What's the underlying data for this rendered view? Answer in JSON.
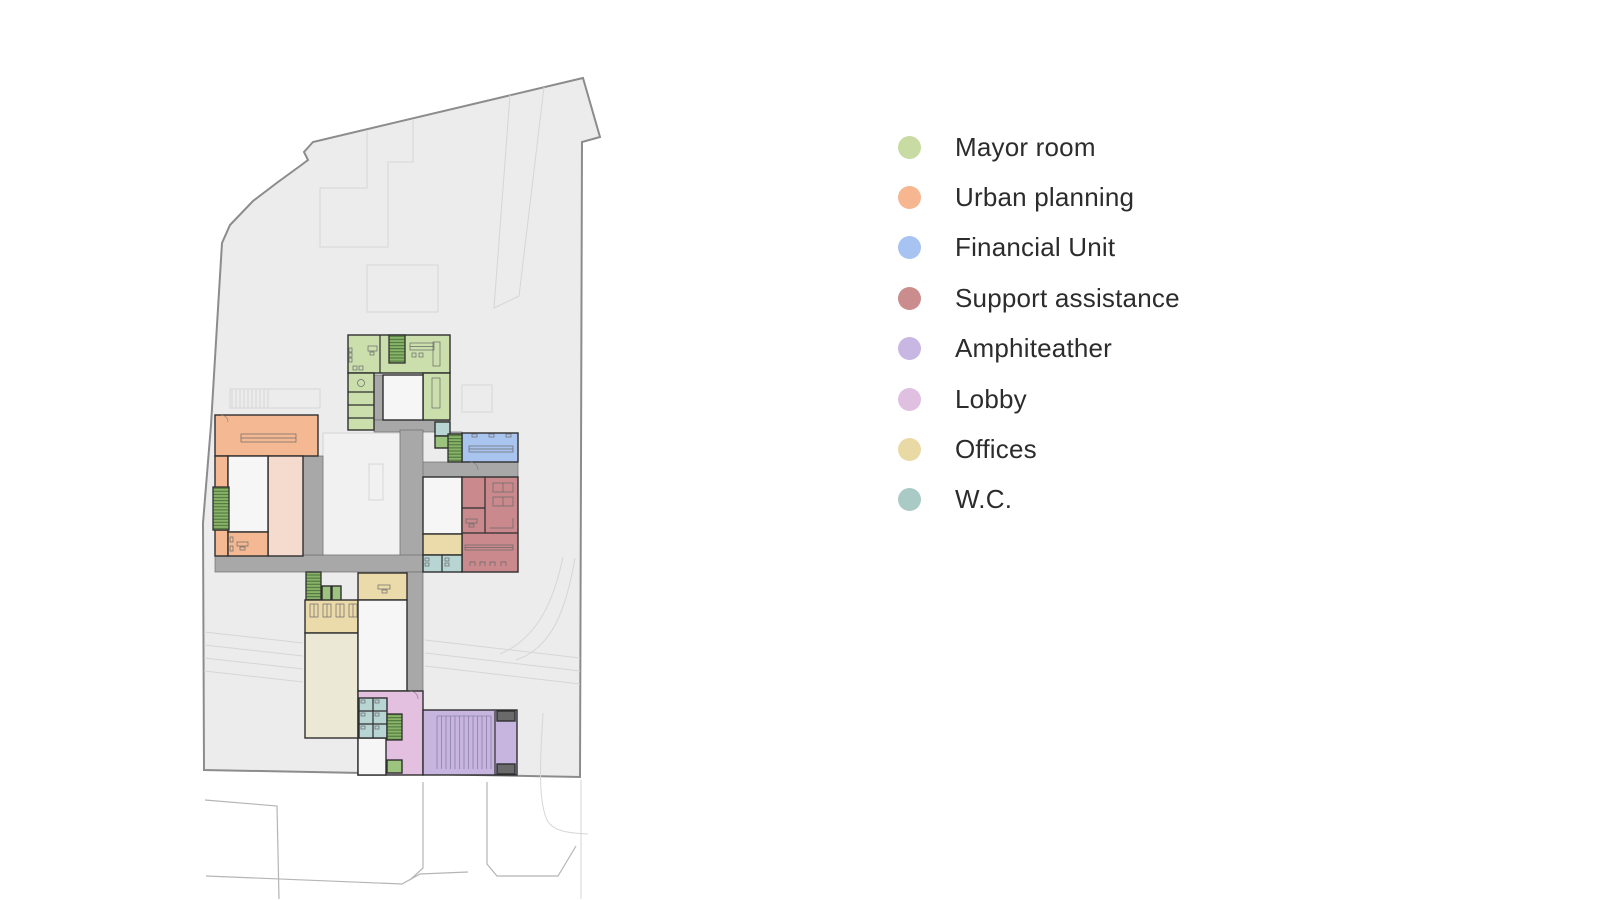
{
  "legend": {
    "items": [
      {
        "id": "mayor-room",
        "label": "Mayor room",
        "color": "#c7dba2"
      },
      {
        "id": "urban-planning",
        "label": "Urban planning",
        "color": "#f5b690"
      },
      {
        "id": "financial-unit",
        "label": "Financial Unit",
        "color": "#a6c3f1"
      },
      {
        "id": "support-assistance",
        "label": "Support assistance",
        "color": "#ca8c8c"
      },
      {
        "id": "amphiteather",
        "label": "Amphiteather",
        "color": "#c8b6e3"
      },
      {
        "id": "lobby",
        "label": "Lobby",
        "color": "#e0c0e0"
      },
      {
        "id": "offices",
        "label": "Offices",
        "color": "#e9d9a5"
      },
      {
        "id": "wc",
        "label": "W.C.",
        "color": "#aacac6"
      }
    ]
  },
  "plan": {
    "type": "architectural-floor-plan",
    "zones": [
      {
        "id": "mayor-room",
        "name": "Mayor room"
      },
      {
        "id": "urban-planning",
        "name": "Urban planning"
      },
      {
        "id": "financial-unit",
        "name": "Financial Unit"
      },
      {
        "id": "support-assistance",
        "name": "Support assistance"
      },
      {
        "id": "amphiteather",
        "name": "Amphiteather"
      },
      {
        "id": "lobby",
        "name": "Lobby"
      },
      {
        "id": "offices",
        "name": "Offices"
      },
      {
        "id": "wc",
        "name": "W.C."
      }
    ],
    "colors": {
      "mayor": "#cbdfad",
      "urban": "#f4b992",
      "urbanLight": "#f5dbce",
      "financial": "#a8c4ef",
      "support": "#c9898d",
      "amphi": "#c7b5df",
      "lobby": "#e3bfe0",
      "offices": "#ecdbaa",
      "cream": "#ece8d6",
      "wc": "#b7d5d3",
      "greenCell": "#9cc47e",
      "stair": "#84b164",
      "corridor": "#a8a8a8",
      "wall": "#2f2f2f",
      "site": "#ececec",
      "siteStroke": "#8c8c8c",
      "faint": "#d6d6d6",
      "road": "#b5b5b5",
      "whiteRoom": "#f6f6f6"
    }
  }
}
